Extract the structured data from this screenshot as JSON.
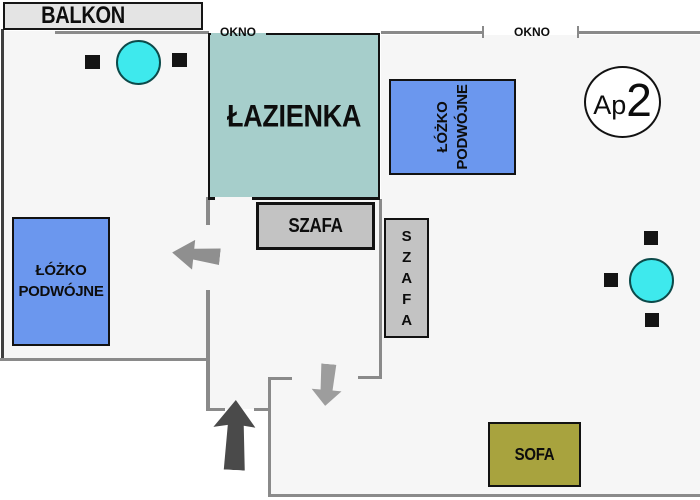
{
  "plan_title": "Apartment 2 floor plan",
  "labels": {
    "balcony": "BALKON",
    "window_left": "OKNO",
    "window_right": "OKNO",
    "bathroom": "ŁAZIENKA",
    "wardrobe_hall": "SZAFA",
    "wardrobe_room": "SZAFA",
    "bed_left": {
      "line1": "ŁÓŻKO",
      "line2": "PODWÓJNE"
    },
    "bed_right": {
      "line1": "ŁÓŻKO",
      "line2": "PODWÓJNE"
    },
    "sofa": "SOFA",
    "badge": {
      "prefix": "Ap",
      "number": "2"
    }
  },
  "icons": {
    "entrance_arrow": "up-arrow",
    "door_arrow_bedroom": "left-arrow",
    "door_arrow_living": "down-arrow"
  },
  "colors": {
    "bathroom_fill": "#a6cecb",
    "bed_fill": "#6b97ee",
    "sofa_fill": "#a8a33e",
    "wardrobe_fill": "#c3c3c3",
    "balcony_fill": "#e4e4e4",
    "table_fill": "#3ee9ed",
    "wall_gray": "#8a8a8a",
    "entrance_arrow_color": "#4a4a4a"
  }
}
